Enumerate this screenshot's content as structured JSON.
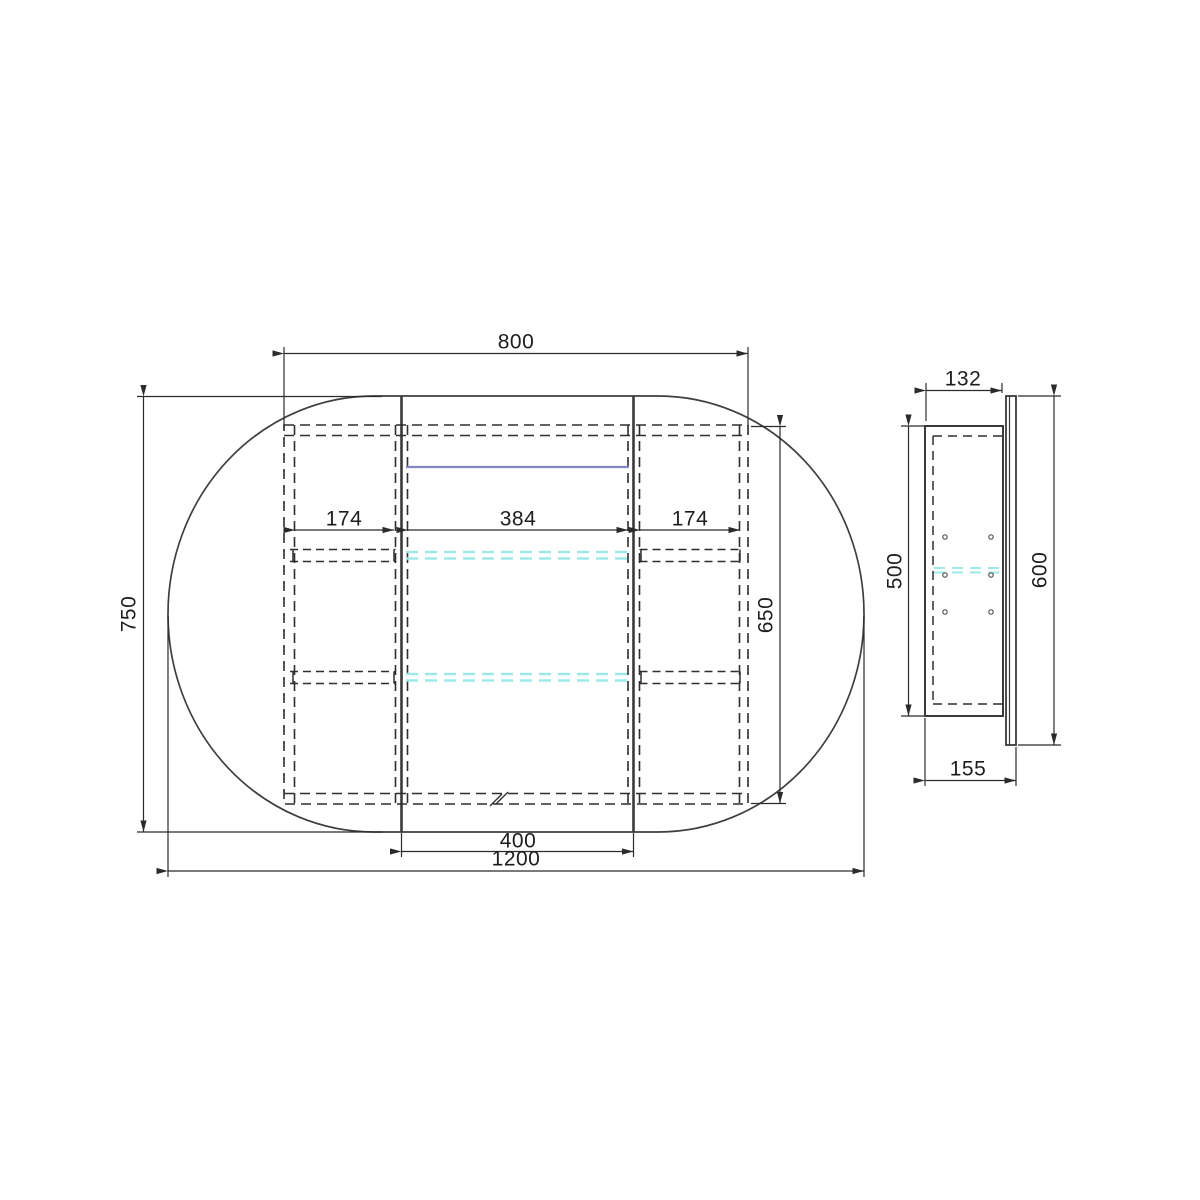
{
  "drawing": {
    "front_view": {
      "dims": {
        "cabinet_width": "800",
        "mirror_height": "750",
        "cabinet_height": "650",
        "left_compartment_width": "174",
        "center_compartment_width": "384",
        "right_compartment_width": "174",
        "center_door_width": "400",
        "mirror_width": "1200"
      }
    },
    "side_view": {
      "dims": {
        "cabinet_depth": "132",
        "cabinet_body_height": "500",
        "mirror_door_height": "600",
        "overall_depth": "155"
      }
    },
    "colors": {
      "line": "#3f3f3f",
      "dashed": "#2e2e2e",
      "dim": "#2b2b2b",
      "glass_shelf": "#9fe8e8",
      "led_strip": "#8287c6"
    }
  }
}
